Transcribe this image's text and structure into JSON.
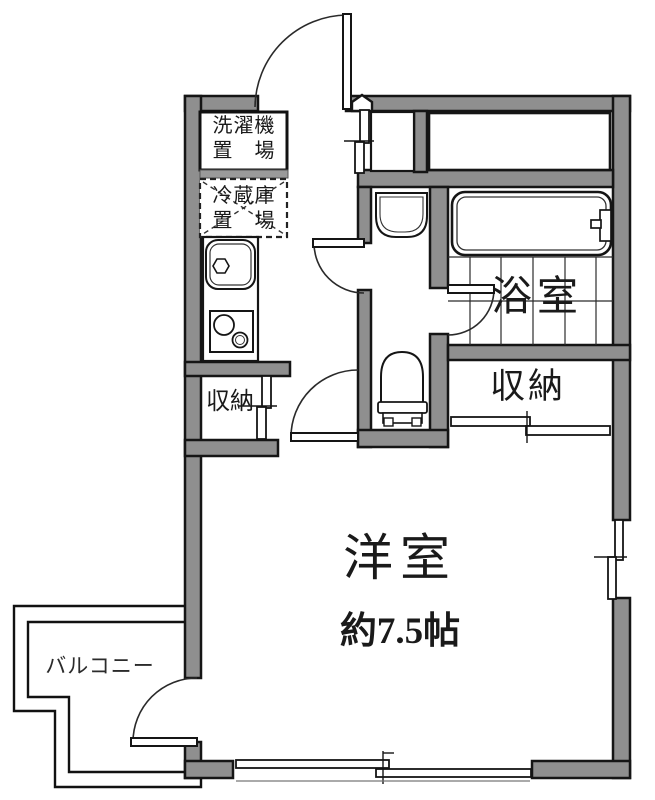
{
  "labels": {
    "washer_line1": "洗濯機",
    "washer_line2": "置　場",
    "fridge_line1": "冷蔵庫",
    "fridge_line2": "置　場",
    "closet_left": "収納",
    "closet_right": "収納",
    "bath": "浴室",
    "room": "洋室",
    "room_size": "約7.5帖",
    "balcony": "バルコニー"
  },
  "colors": {
    "background": "#ffffff",
    "wall_fill": "#8f8f8f",
    "line": "#1a1a1a"
  }
}
